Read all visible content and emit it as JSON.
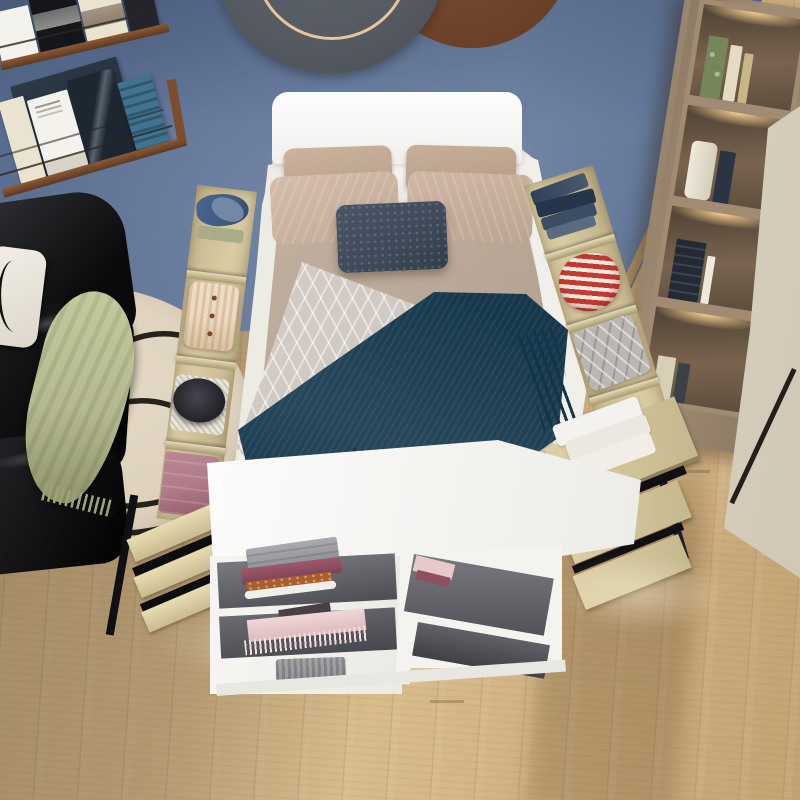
{
  "scene": {
    "type": "bedroom-product-photo",
    "description": "Top-down view of a white storage platform bed with open side compartments and drawers filled with folded clothes, a foot-of-bed white cabinet with grey shelves, black leather sofa with sage throw, cream squiggle rug, wall magazine shelves, round wall decor, wooden bookshelf and cream wardrobe on a light oak floor against a slate-blue wall",
    "palette": {
      "wall": "#64789b",
      "floor_light": "#e6cda1",
      "floor_mid": "#d8bb8c",
      "floor_dark": "#c4a375",
      "baseboard": "#b2956c",
      "rug": "#dcd0bc",
      "rug_line": "#16120d",
      "sofa_pillow": "#f2eee6",
      "sage": "#b5b98f",
      "headboard": "#f1f0ed",
      "bed_frame": "#f4f2ee",
      "duvet": "#b3a08f",
      "pillow_tan": "#b89f8a",
      "cushion_navy": "#3e4a59",
      "pattern_throw": "#d0c8c2",
      "teal": "#16384c",
      "teal_dark": "#123348",
      "blush": "#c8b2a9",
      "plywood": "#d9cca3",
      "denim": "#3f5a82",
      "denim_light": "#7388a7",
      "knit_cream": "#ecd9c0",
      "hat": "#26262c",
      "mauve": "#b07c8a",
      "jeans": "#31415a",
      "stripe_red": "#c23a32",
      "stripe_white": "#f2e9e0",
      "grey_pillow": "#bab6b2",
      "towel": "#f4f2ee",
      "cabinet_white": "#f3f2ef",
      "shelf_grey": "#4c4e53",
      "shelf_grey_light": "#74767c",
      "grey_stack": "#aaabb1",
      "berry": "#9b5a6c",
      "orange": "#a85e2d",
      "pink_scarf": "#f0d8d8",
      "grey_knit": "#a8a6a9",
      "bookshelf_wood": "#a28d75",
      "cubby_dark": "#7a6450",
      "wardrobe": "#ece5d8",
      "decor_grey": "#565b62",
      "decor_copper": "#7e5134",
      "copper_ring": "#e7c59d",
      "book_navy": "#27323f",
      "book_cream": "#e9e3d0",
      "book_white": "#f4f2ec",
      "book_photo": "#1d2732",
      "book_blue": "#41738f",
      "book_green": "#76865a"
    },
    "objects": [
      {
        "name": "wall",
        "label": "slate blue wall"
      },
      {
        "name": "wall-decor",
        "label": "two overlapping round wall discs, charcoal with copper ring and copper"
      },
      {
        "name": "magazine-shelves",
        "label": "two wooden wall rails displaying magazines and books"
      },
      {
        "name": "sofa",
        "label": "black leather sofa with white pillow and sage green throw"
      },
      {
        "name": "rug",
        "label": "round cream rug with black squiggle line art"
      },
      {
        "name": "bed",
        "label": "white storage bed with tan pillows, navy cushion, taupe duvet, geometric throw and teal fringed knit blanket"
      },
      {
        "name": "left-storage",
        "label": "open side compartments: denim pile, cream cable-knit cardigan, black hat, mauve folded clothes; three closed plywood drawers"
      },
      {
        "name": "right-storage",
        "label": "open side compartments: dark jeans stack, red striped shirt, grey patterned pillow; open drawers with white towels"
      },
      {
        "name": "foot-cabinet",
        "label": "white cabinet with grey shelves holding grey, berry, orange stacks, pink fringed scarf and grey knit"
      },
      {
        "name": "bookshelf",
        "label": "wooden cube bookshelf with lit shelves and books"
      },
      {
        "name": "wardrobe",
        "label": "cream wardrobe panel with dark seam"
      },
      {
        "name": "floor",
        "label": "light oak plank floor with soft shadows"
      }
    ]
  }
}
